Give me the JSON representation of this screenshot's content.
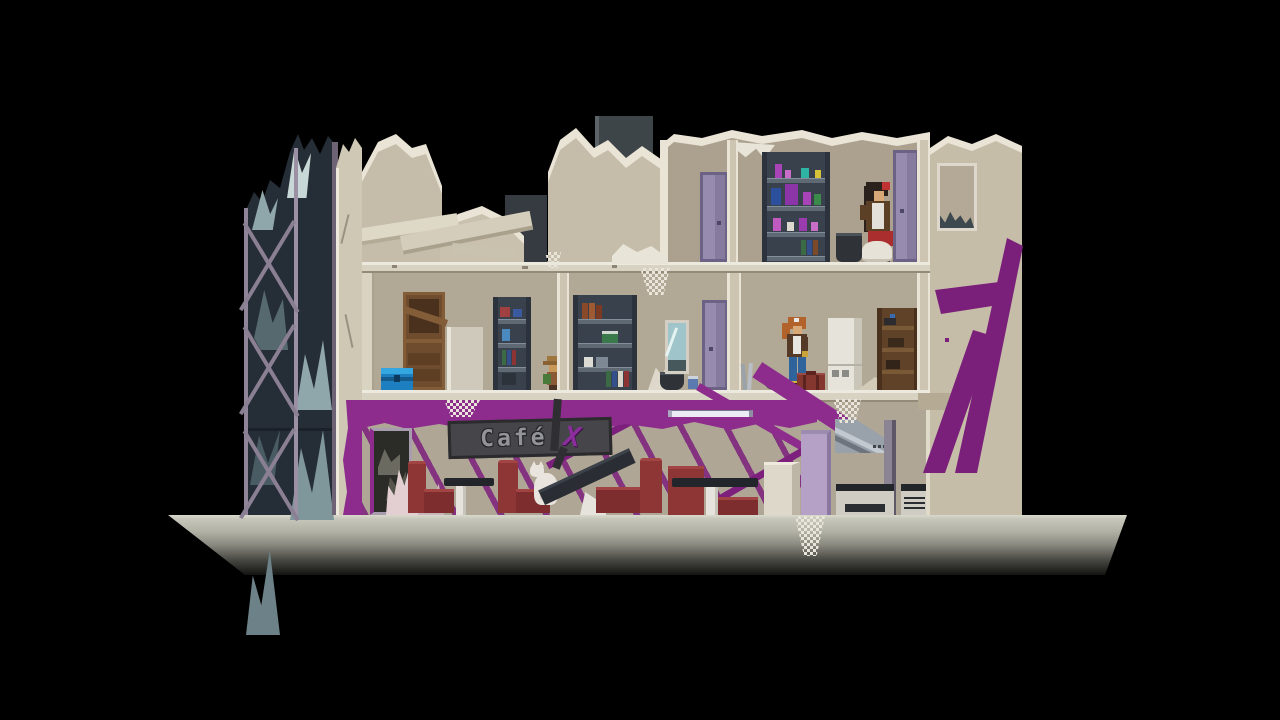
{
  "scene": {
    "title": "Ruined cafe building cross-section (pixel-art game scene)",
    "sign": {
      "text": "Café",
      "accent": "X"
    },
    "colors": {
      "background": "#000000",
      "wall_interior": "#b2a896",
      "wall_exterior": "#c6bda8",
      "wall_highlight": "#e9e4d6",
      "floor_slab": "#d8d2c2",
      "purple_paint": "#8d2c8d",
      "graffiti_purple": "#7a1f7a",
      "door_purple": "#978cb0",
      "door_lilac": "#b5a1c6",
      "sofa_red": "#8e3636",
      "glass_tower": "#252d36",
      "metal_shelf": "#39414d",
      "wood_brown": "#6f4c2d",
      "chest_blue": "#1d7fc0",
      "platform_top": "#c9c9bd"
    },
    "entities": {
      "girl": "girl-with-red-bow",
      "traveler": "traveler-with-ponytail",
      "creature": "small-creature-with-hat",
      "cat": "white-cat"
    }
  }
}
